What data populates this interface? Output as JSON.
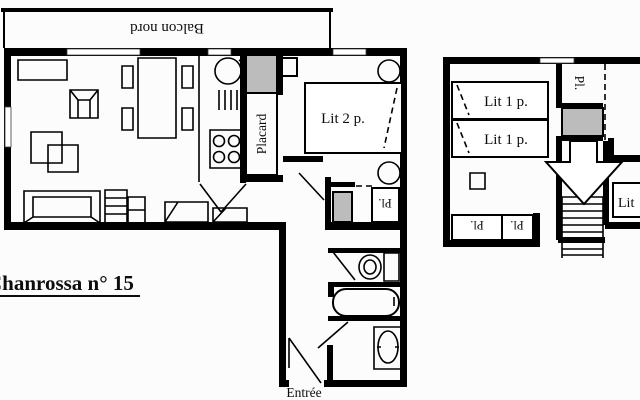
{
  "colors": {
    "ink": "#000000",
    "shade": "#bcbcbc",
    "background": "#fcfcfc"
  },
  "title": {
    "text": "Chanrossa n° 15"
  },
  "ground_floor": {
    "balcony": "Balcon nord",
    "closet": "Placard",
    "double_bed": "Lit 2 p.",
    "hall_closet": "Pl.",
    "entrance": "Entrée"
  },
  "upper_floor": {
    "single_bed_top": "Lit 1 p.",
    "single_bed_bottom": "Lit 1 p.",
    "closet": "Pl.",
    "closet_left": "Pl.",
    "closet_right": "Pl.",
    "bed_partial": "Lit"
  }
}
